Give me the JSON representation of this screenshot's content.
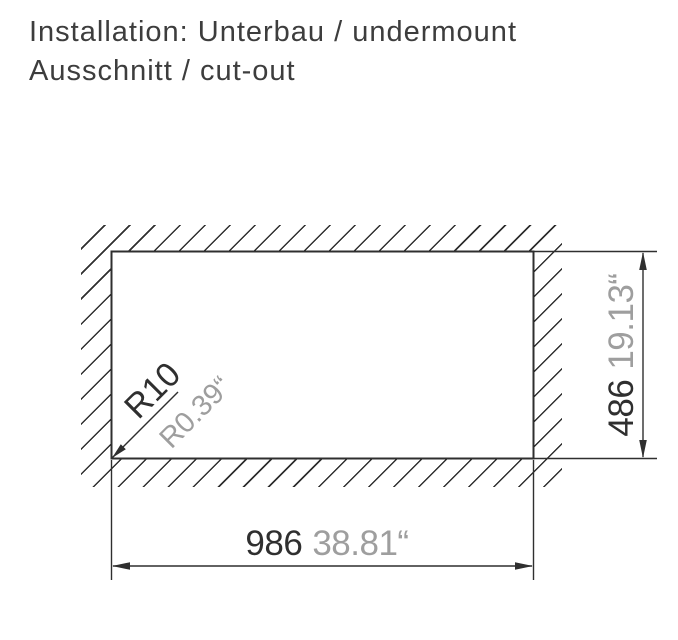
{
  "title": {
    "line1": "Installation: Unterbau / undermount",
    "line2": "Ausschnitt / cut-out"
  },
  "drawing": {
    "type": "undermount-sink-cutout-technical-drawing",
    "dimensions": {
      "width_mm": "986",
      "width_inch": "38.81“",
      "height_mm": "486",
      "height_inch": "19.13“",
      "corner_radius_mm": "R10",
      "corner_radius_inch": "R0.39“"
    },
    "colors": {
      "line": "#2f2f2f",
      "primary_text": "#3d3d3d",
      "secondary_text": "#9e9e9e",
      "background": "#ffffff"
    }
  }
}
